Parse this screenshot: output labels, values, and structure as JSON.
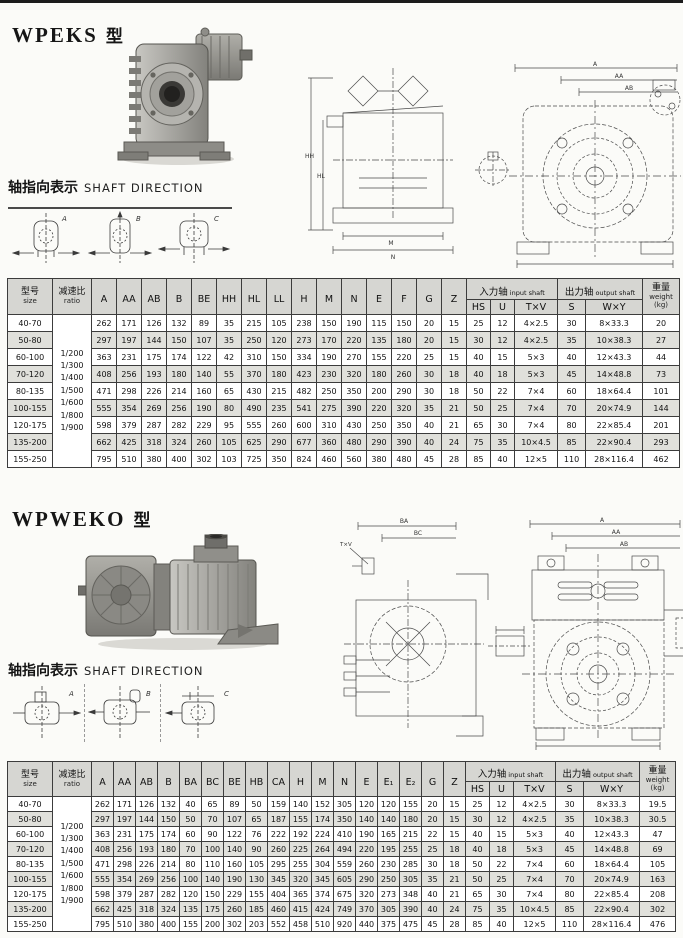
{
  "sections": [
    {
      "title_model": "WPEKS",
      "title_type": "型",
      "shaft_label_zh": "轴指向表示",
      "shaft_label_en": "SHAFT DIRECTION",
      "diagrams": [
        "A",
        "B",
        "C"
      ],
      "drawing": {
        "side_labels": [
          "HH",
          "HL",
          "M",
          "N"
        ],
        "front_labels": [
          "A",
          "AA",
          "AB"
        ]
      },
      "table": {
        "header": {
          "size_zh": "型号",
          "size_en": "size",
          "ratio_zh": "减速比",
          "ratio_en": "ratio",
          "dims": [
            "A",
            "AA",
            "AB",
            "B",
            "BE",
            "HH",
            "HL",
            "LL",
            "H",
            "M",
            "N",
            "E",
            "F",
            "G",
            "Z"
          ],
          "input_zh": "入力轴",
          "input_en": "input shaft",
          "input_cols": [
            "HS",
            "U",
            "T×V"
          ],
          "output_zh": "出力轴",
          "output_en": "output shaft",
          "output_cols": [
            "S",
            "W×Y"
          ],
          "weight_zh": "重量",
          "weight_en": "weight",
          "weight_unit": "(kg)"
        },
        "ratios": "1/200\n1/300\n1/400\n1/500\n1/600\n1/800\n1/900",
        "rows": [
          {
            "size": "40-70",
            "dims": [
              "262",
              "171",
              "126",
              "132",
              "89",
              "35",
              "215",
              "105",
              "238",
              "150",
              "190",
              "115",
              "150",
              "20",
              "15"
            ],
            "input": [
              "25",
              "12",
              "4×2.5"
            ],
            "output": [
              "30",
              "8×33.3"
            ],
            "weight": "20"
          },
          {
            "size": "50-80",
            "dims": [
              "297",
              "197",
              "144",
              "150",
              "107",
              "35",
              "250",
              "120",
              "273",
              "170",
              "220",
              "135",
              "180",
              "20",
              "15"
            ],
            "input": [
              "30",
              "12",
              "4×2.5"
            ],
            "output": [
              "35",
              "10×38.3"
            ],
            "weight": "27"
          },
          {
            "size": "60-100",
            "dims": [
              "363",
              "231",
              "175",
              "174",
              "122",
              "42",
              "310",
              "150",
              "334",
              "190",
              "270",
              "155",
              "220",
              "25",
              "15"
            ],
            "input": [
              "40",
              "15",
              "5×3"
            ],
            "output": [
              "40",
              "12×43.3"
            ],
            "weight": "44"
          },
          {
            "size": "70-120",
            "dims": [
              "408",
              "256",
              "193",
              "180",
              "140",
              "55",
              "370",
              "180",
              "423",
              "230",
              "320",
              "180",
              "260",
              "30",
              "18"
            ],
            "input": [
              "40",
              "18",
              "5×3"
            ],
            "output": [
              "45",
              "14×48.8"
            ],
            "weight": "73"
          },
          {
            "size": "80-135",
            "dims": [
              "471",
              "298",
              "226",
              "214",
              "160",
              "65",
              "430",
              "215",
              "482",
              "250",
              "350",
              "200",
              "290",
              "30",
              "18"
            ],
            "input": [
              "50",
              "22",
              "7×4"
            ],
            "output": [
              "60",
              "18×64.4"
            ],
            "weight": "101"
          },
          {
            "size": "100-155",
            "dims": [
              "555",
              "354",
              "269",
              "256",
              "190",
              "80",
              "490",
              "235",
              "541",
              "275",
              "390",
              "220",
              "320",
              "35",
              "21"
            ],
            "input": [
              "50",
              "25",
              "7×4"
            ],
            "output": [
              "70",
              "20×74.9"
            ],
            "weight": "144"
          },
          {
            "size": "120-175",
            "dims": [
              "598",
              "379",
              "287",
              "282",
              "229",
              "95",
              "555",
              "260",
              "600",
              "310",
              "430",
              "250",
              "350",
              "40",
              "21"
            ],
            "input": [
              "65",
              "30",
              "7×4"
            ],
            "output": [
              "80",
              "22×85.4"
            ],
            "weight": "201"
          },
          {
            "size": "135-200",
            "dims": [
              "662",
              "425",
              "318",
              "324",
              "260",
              "105",
              "625",
              "290",
              "677",
              "360",
              "480",
              "290",
              "390",
              "40",
              "24"
            ],
            "input": [
              "75",
              "35",
              "10×4.5"
            ],
            "output": [
              "85",
              "22×90.4"
            ],
            "weight": "293"
          },
          {
            "size": "155-250",
            "dims": [
              "795",
              "510",
              "380",
              "400",
              "302",
              "103",
              "725",
              "350",
              "824",
              "460",
              "560",
              "380",
              "480",
              "45",
              "28"
            ],
            "input": [
              "85",
              "40",
              "12×5"
            ],
            "output": [
              "110",
              "28×116.4"
            ],
            "weight": "462"
          }
        ]
      }
    },
    {
      "title_model": "WPWEKO",
      "title_type": "型",
      "shaft_label_zh": "轴指向表示",
      "shaft_label_en": "SHAFT DIRECTION",
      "diagrams": [
        "A",
        "B",
        "C"
      ],
      "drawing": {
        "left_labels": [
          "BA",
          "BC",
          "T×V"
        ],
        "front_labels": [
          "A",
          "AA",
          "AB"
        ]
      },
      "table": {
        "header": {
          "size_zh": "型号",
          "size_en": "size",
          "ratio_zh": "减速比",
          "ratio_en": "ratio",
          "dims": [
            "A",
            "AA",
            "AB",
            "B",
            "BA",
            "BC",
            "BE",
            "HB",
            "CA",
            "H",
            "M",
            "N",
            "E",
            "E₁",
            "E₂",
            "G",
            "Z"
          ],
          "input_zh": "入力轴",
          "input_en": "input shaft",
          "input_cols": [
            "HS",
            "U",
            "T×V"
          ],
          "output_zh": "出力轴",
          "output_en": "output shaft",
          "output_cols": [
            "S",
            "W×Y"
          ],
          "weight_zh": "重量",
          "weight_en": "weight",
          "weight_unit": "(kg)"
        },
        "ratios": "1/200\n1/300\n1/400\n1/500\n1/600\n1/800\n1/900",
        "rows": [
          {
            "size": "40-70",
            "dims": [
              "262",
              "171",
              "126",
              "132",
              "40",
              "65",
              "89",
              "50",
              "159",
              "140",
              "152",
              "305",
              "120",
              "120",
              "155",
              "20",
              "15"
            ],
            "input": [
              "25",
              "12",
              "4×2.5"
            ],
            "output": [
              "30",
              "8×33.3"
            ],
            "weight": "19.5"
          },
          {
            "size": "50-80",
            "dims": [
              "297",
              "197",
              "144",
              "150",
              "50",
              "70",
              "107",
              "65",
              "187",
              "155",
              "174",
              "350",
              "140",
              "140",
              "180",
              "20",
              "15"
            ],
            "input": [
              "30",
              "12",
              "4×2.5"
            ],
            "output": [
              "35",
              "10×38.3"
            ],
            "weight": "30.5"
          },
          {
            "size": "60-100",
            "dims": [
              "363",
              "231",
              "175",
              "174",
              "60",
              "90",
              "122",
              "76",
              "222",
              "192",
              "224",
              "410",
              "190",
              "165",
              "215",
              "22",
              "15"
            ],
            "input": [
              "40",
              "15",
              "5×3"
            ],
            "output": [
              "40",
              "12×43.3"
            ],
            "weight": "47"
          },
          {
            "size": "70-120",
            "dims": [
              "408",
              "256",
              "193",
              "180",
              "70",
              "100",
              "140",
              "90",
              "260",
              "225",
              "264",
              "494",
              "220",
              "195",
              "255",
              "25",
              "18"
            ],
            "input": [
              "40",
              "18",
              "5×3"
            ],
            "output": [
              "45",
              "14×48.8"
            ],
            "weight": "69"
          },
          {
            "size": "80-135",
            "dims": [
              "471",
              "298",
              "226",
              "214",
              "80",
              "110",
              "160",
              "105",
              "295",
              "255",
              "304",
              "559",
              "260",
              "230",
              "285",
              "30",
              "18"
            ],
            "input": [
              "50",
              "22",
              "7×4"
            ],
            "output": [
              "60",
              "18×64.4"
            ],
            "weight": "105"
          },
          {
            "size": "100-155",
            "dims": [
              "555",
              "354",
              "269",
              "256",
              "100",
              "140",
              "190",
              "130",
              "345",
              "320",
              "345",
              "605",
              "290",
              "250",
              "305",
              "35",
              "21"
            ],
            "input": [
              "50",
              "25",
              "7×4"
            ],
            "output": [
              "70",
              "20×74.9"
            ],
            "weight": "163"
          },
          {
            "size": "120-175",
            "dims": [
              "598",
              "379",
              "287",
              "282",
              "120",
              "150",
              "229",
              "155",
              "404",
              "365",
              "374",
              "675",
              "320",
              "273",
              "348",
              "40",
              "21"
            ],
            "input": [
              "65",
              "30",
              "7×4"
            ],
            "output": [
              "80",
              "22×85.4"
            ],
            "weight": "208"
          },
          {
            "size": "135-200",
            "dims": [
              "662",
              "425",
              "318",
              "324",
              "135",
              "175",
              "260",
              "185",
              "460",
              "415",
              "424",
              "749",
              "370",
              "305",
              "390",
              "40",
              "24"
            ],
            "input": [
              "75",
              "35",
              "10×4.5"
            ],
            "output": [
              "85",
              "22×90.4"
            ],
            "weight": "302"
          },
          {
            "size": "155-250",
            "dims": [
              "795",
              "510",
              "380",
              "400",
              "155",
              "200",
              "302",
              "203",
              "552",
              "458",
              "510",
              "920",
              "440",
              "375",
              "475",
              "45",
              "28"
            ],
            "input": [
              "85",
              "40",
              "12×5"
            ],
            "output": [
              "110",
              "28×116.4"
            ],
            "weight": "476"
          }
        ]
      }
    }
  ]
}
